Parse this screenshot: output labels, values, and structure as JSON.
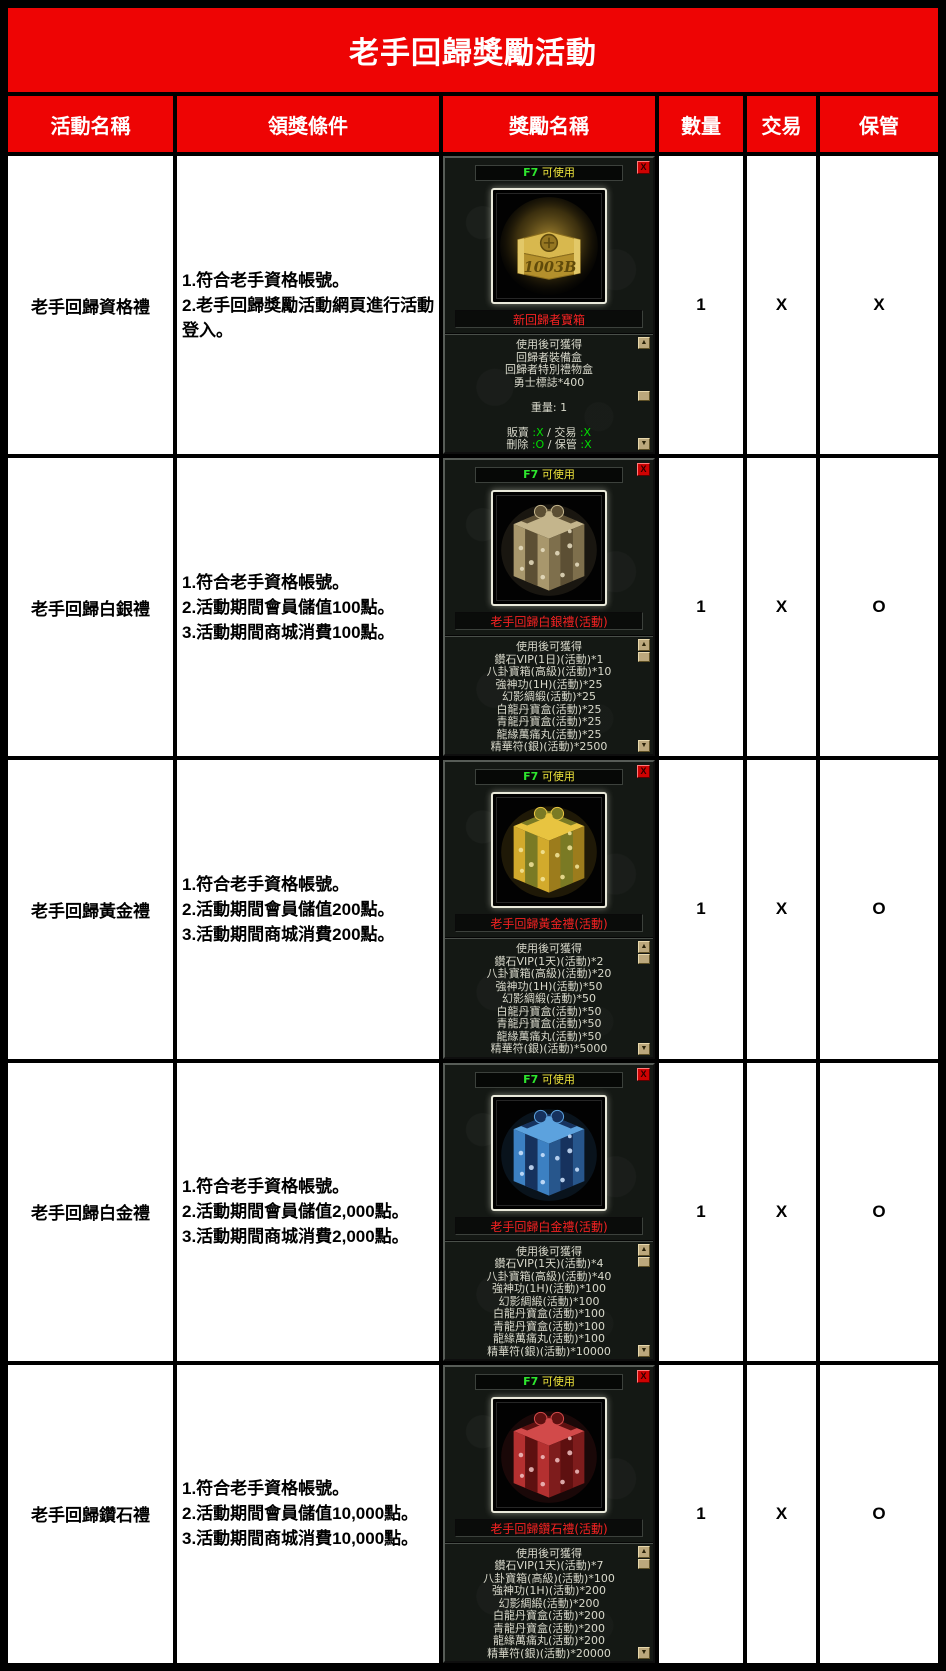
{
  "title": "老手回歸獎勵活動",
  "columns": [
    "活動名稱",
    "領獎條件",
    "獎勵名稱",
    "數量",
    "交易",
    "保管"
  ],
  "colors": {
    "header_red": "#ee0404",
    "item_name_red": "#f52222",
    "hotkey_green": "#2ee62e",
    "usable_yellow": "#f0e63c",
    "status_green": "#00dd00"
  },
  "tooltip_chrome": {
    "scroll_up": "▲",
    "scroll_down": "▼"
  },
  "rows": [
    {
      "name": "老手回歸資格禮",
      "conditions": [
        "1.符合老手資格帳號。",
        "2.老手回歸獎勵活動網頁進行活動登入。"
      ],
      "quantity": "1",
      "trade": "X",
      "storage": "X",
      "tooltip": {
        "hotkey": "F7",
        "usable": "可使用",
        "close_label": "X",
        "item_name": "新回歸者寶箱",
        "icon": {
          "type": "chest",
          "name": "gold-chest-icon",
          "label": "1003B"
        },
        "thumb_top": 56,
        "lines": [
          [
            [
              "使用後可獲得",
              ""
            ]
          ],
          [
            [
              "回歸者裝備盒",
              ""
            ]
          ],
          [
            [
              "回歸者特別禮物盒",
              ""
            ]
          ],
          [
            [
              "勇士標誌*400",
              ""
            ]
          ],
          [
            [
              "",
              ""
            ]
          ],
          [
            [
              "重量: 1",
              ""
            ]
          ],
          [
            [
              "",
              ""
            ]
          ],
          [
            [
              "販賣 ",
              ""
            ],
            [
              ":X",
              "g"
            ],
            [
              " / ",
              ""
            ],
            [
              "交易 ",
              ""
            ],
            [
              ":X",
              "g"
            ]
          ],
          [
            [
              "刪除 ",
              ""
            ],
            [
              ":O",
              "g"
            ],
            [
              " / ",
              ""
            ],
            [
              "保管 ",
              ""
            ],
            [
              ":X",
              "g"
            ]
          ]
        ]
      }
    },
    {
      "name": "老手回歸白銀禮",
      "conditions": [
        "1.符合老手資格帳號。",
        "2.活動期間會員儲值100點。",
        "3.活動期間商城消費100點。"
      ],
      "quantity": "1",
      "trade": "X",
      "storage": "O",
      "tooltip": {
        "hotkey": "F7",
        "usable": "可使用",
        "close_label": "X",
        "item_name": "老手回歸白銀禮(活動)",
        "icon": {
          "type": "gift",
          "name": "silver-gift-box-icon",
          "top": "#c4b58c",
          "body": "#a8976c",
          "dark": "#7e6f4c",
          "ribbon": "#5c4f34",
          "deco": "#e8dfc2"
        },
        "thumb_top": 15,
        "lines": [
          [
            [
              "使用後可獲得",
              ""
            ]
          ],
          [
            [
              "鑽石VIP(1日)(活動)*1",
              ""
            ]
          ],
          [
            [
              "八卦寶箱(高級)(活動)*10",
              ""
            ]
          ],
          [
            [
              "強神功(1H)(活動)*25",
              ""
            ]
          ],
          [
            [
              "幻影綢緞(活動)*25",
              ""
            ]
          ],
          [
            [
              "白龍丹寶盒(活動)*25",
              ""
            ]
          ],
          [
            [
              "青龍丹寶盒(活動)*25",
              ""
            ]
          ],
          [
            [
              "龍緣萬痛丸(活動)*25",
              ""
            ]
          ],
          [
            [
              "精華符(銀)(活動)*2500",
              ""
            ]
          ]
        ]
      }
    },
    {
      "name": "老手回歸黃金禮",
      "conditions": [
        "1.符合老手資格帳號。",
        "2.活動期間會員儲值200點。",
        "3.活動期間商城消費200點。"
      ],
      "quantity": "1",
      "trade": "X",
      "storage": "O",
      "tooltip": {
        "hotkey": "F7",
        "usable": "可使用",
        "close_label": "X",
        "item_name": "老手回歸黃金禮(活動)",
        "icon": {
          "type": "gift",
          "name": "gold-gift-box-icon",
          "top": "#e8c440",
          "body": "#d2aa2c",
          "dark": "#9c7c1c",
          "ribbon": "#7a7a24",
          "deco": "#f4e69c"
        },
        "thumb_top": 15,
        "lines": [
          [
            [
              "使用後可獲得",
              ""
            ]
          ],
          [
            [
              "鑽石VIP(1天)(活動)*2",
              ""
            ]
          ],
          [
            [
              "八卦寶箱(高級)(活動)*20",
              ""
            ]
          ],
          [
            [
              "強神功(1H)(活動)*50",
              ""
            ]
          ],
          [
            [
              "幻影綢緞(活動)*50",
              ""
            ]
          ],
          [
            [
              "白龍丹寶盒(活動)*50",
              ""
            ]
          ],
          [
            [
              "青龍丹寶盒(活動)*50",
              ""
            ]
          ],
          [
            [
              "龍緣萬痛丸(活動)*50",
              ""
            ]
          ],
          [
            [
              "精華符(銀)(活動)*5000",
              ""
            ]
          ]
        ]
      }
    },
    {
      "name": "老手回歸白金禮",
      "conditions": [
        "1.符合老手資格帳號。",
        "2.活動期間會員儲值2,000點。",
        "3.活動期間商城消費2,000點。"
      ],
      "quantity": "1",
      "trade": "X",
      "storage": "O",
      "tooltip": {
        "hotkey": "F7",
        "usable": "可使用",
        "close_label": "X",
        "item_name": "老手回歸白金禮(活動)",
        "icon": {
          "type": "gift",
          "name": "blue-gift-box-icon",
          "top": "#5ca2de",
          "body": "#3c80c2",
          "dark": "#27568c",
          "ribbon": "#16325e",
          "deco": "#d0e5ff"
        },
        "thumb_top": 15,
        "lines": [
          [
            [
              "使用後可獲得",
              ""
            ]
          ],
          [
            [
              "鑽石VIP(1天)(活動)*4",
              ""
            ]
          ],
          [
            [
              "八卦寶箱(高級)(活動)*40",
              ""
            ]
          ],
          [
            [
              "強神功(1H)(活動)*100",
              ""
            ]
          ],
          [
            [
              "幻影綢緞(活動)*100",
              ""
            ]
          ],
          [
            [
              "白龍丹寶盒(活動)*100",
              ""
            ]
          ],
          [
            [
              "青龍丹寶盒(活動)*100",
              ""
            ]
          ],
          [
            [
              "龍緣萬痛丸(活動)*100",
              ""
            ]
          ],
          [
            [
              "精華符(銀)(活動)*10000",
              ""
            ]
          ]
        ]
      }
    },
    {
      "name": "老手回歸鑽石禮",
      "conditions": [
        "1.符合老手資格帳號。",
        "2.活動期間會員儲值10,000點。",
        "3.活動期間商城消費10,000點。"
      ],
      "quantity": "1",
      "trade": "X",
      "storage": "O",
      "tooltip": {
        "hotkey": "F7",
        "usable": "可使用",
        "close_label": "X",
        "item_name": "老手回歸鑽石禮(活動)",
        "icon": {
          "type": "gift",
          "name": "red-gift-box-icon",
          "top": "#d24a4a",
          "body": "#b43030",
          "dark": "#7e1c1c",
          "ribbon": "#5e1010",
          "deco": "#f0c2c2"
        },
        "thumb_top": 15,
        "lines": [
          [
            [
              "使用後可獲得",
              ""
            ]
          ],
          [
            [
              "鑽石VIP(1天)(活動)*7",
              ""
            ]
          ],
          [
            [
              "八卦寶箱(高級)(活動)*100",
              ""
            ]
          ],
          [
            [
              "強神功(1H)(活動)*200",
              ""
            ]
          ],
          [
            [
              "幻影綢緞(活動)*200",
              ""
            ]
          ],
          [
            [
              "白龍丹寶盒(活動)*200",
              ""
            ]
          ],
          [
            [
              "青龍丹寶盒(活動)*200",
              ""
            ]
          ],
          [
            [
              "龍緣萬痛丸(活動)*200",
              ""
            ]
          ],
          [
            [
              "精華符(銀)(活動)*20000",
              ""
            ]
          ]
        ]
      }
    }
  ]
}
